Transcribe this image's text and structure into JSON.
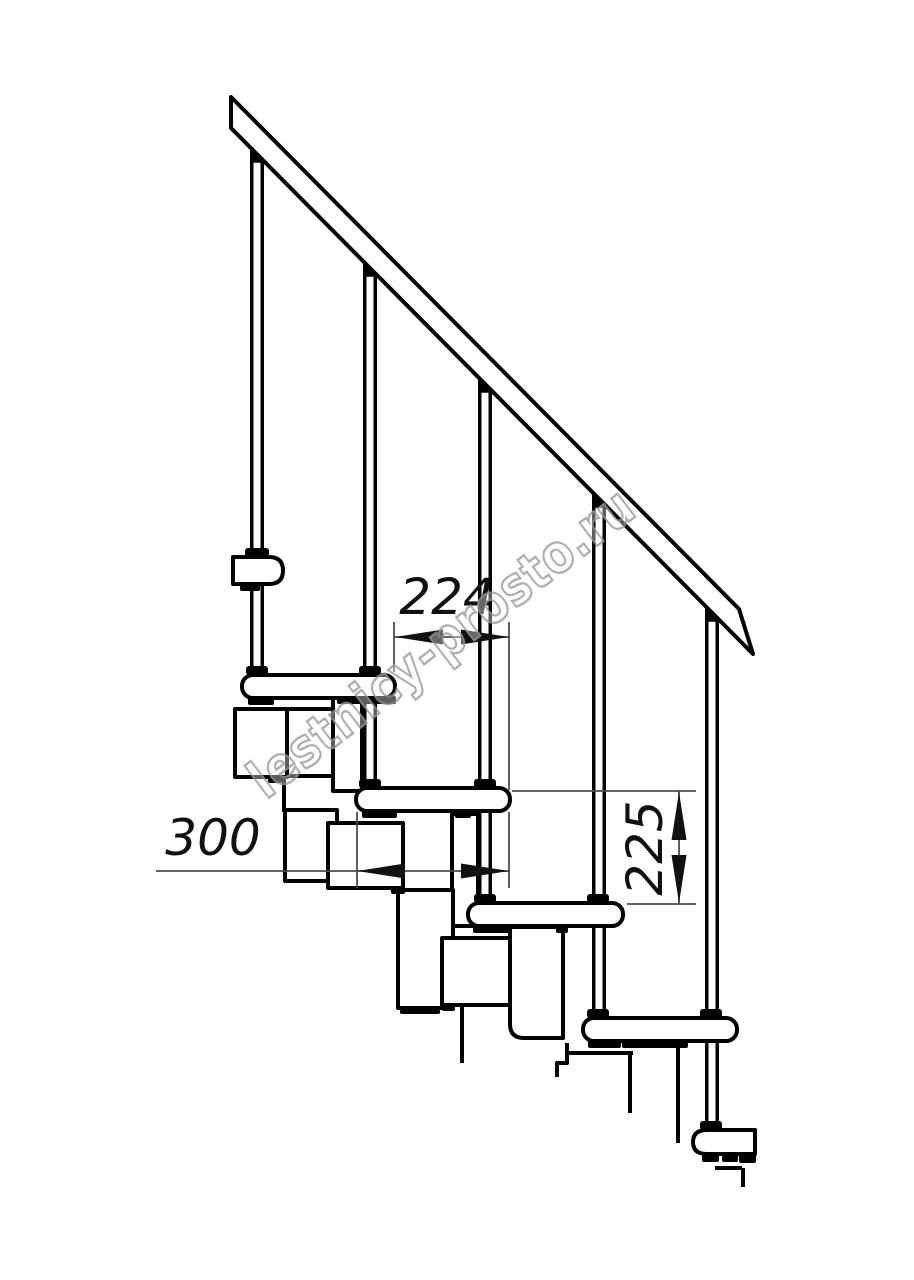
{
  "drawing": {
    "watermark": "lestnicy-prosto.ru",
    "dimensions": {
      "step_run": "224",
      "tread_depth": "300",
      "riser_height": "225"
    },
    "colors": {
      "line": "#000000",
      "dimension_line": "#4d4d4d",
      "watermark": "#9c9c9c",
      "background": "#ffffff"
    }
  }
}
